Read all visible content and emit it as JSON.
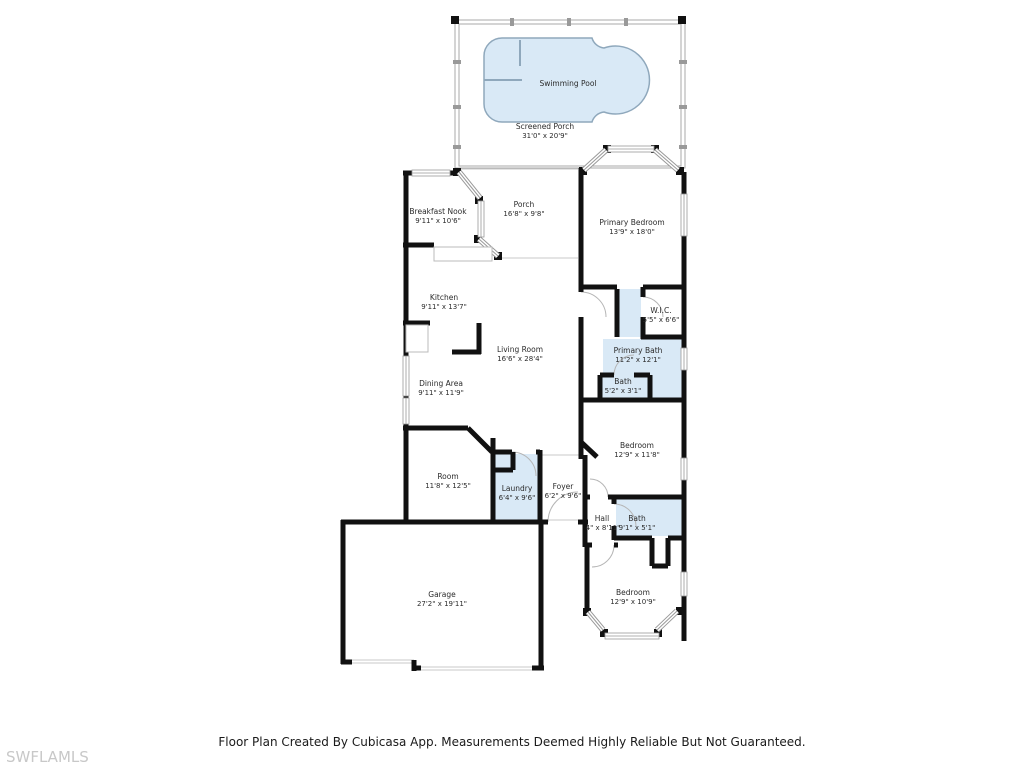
{
  "title": "Floor Plan",
  "footer": {
    "text": "Floor Plan Created By Cubicasa App. Measurements Deemed Highly Reliable But Not Guaranteed."
  },
  "watermark": {
    "text": "SWFLAMLS"
  },
  "colors": {
    "wall": "#111111",
    "water": "#d9e9f6",
    "pool_stroke": "#8fa8bc",
    "window": "#999999",
    "screen_wall": "#aaaaaa",
    "open_line": "#c9c9c9",
    "label": "#2b2b2b",
    "watermark": "#c8c8c8"
  },
  "rooms": [
    {
      "name": "Swimming Pool",
      "dims": ""
    },
    {
      "name": "Screened Porch",
      "dims": "31'0\" x 20'9\""
    },
    {
      "name": "Breakfast Nook",
      "dims": "9'11\" x 10'6\""
    },
    {
      "name": "Porch",
      "dims": "16'8\" x 9'8\""
    },
    {
      "name": "Primary Bedroom",
      "dims": "13'9\" x 18'0\""
    },
    {
      "name": "Kitchen",
      "dims": "9'11\" x 13'7\""
    },
    {
      "name": "W.I.C.",
      "dims": "5'5\" x 6'6\""
    },
    {
      "name": "Living Room",
      "dims": "16'6\" x 28'4\""
    },
    {
      "name": "Primary Bath",
      "dims": "11'2\" x 12'1\""
    },
    {
      "name": "Dining Area",
      "dims": "9'11\" x 11'9\""
    },
    {
      "name": "Bath",
      "dims": "5'2\" x 3'1\""
    },
    {
      "name": "Bedroom",
      "dims": "12'9\" x 11'8\""
    },
    {
      "name": "Room",
      "dims": "11'8\" x 12'5\""
    },
    {
      "name": "Laundry",
      "dims": "6'4\" x 9'6\""
    },
    {
      "name": "Foyer",
      "dims": "6'2\" x 9'6\""
    },
    {
      "name": "Hall",
      "dims": "4\" x 8'11\""
    },
    {
      "name": "Bath",
      "dims": "9'1\" x 5'1\""
    },
    {
      "name": "Garage",
      "dims": "27'2\" x 19'11\""
    },
    {
      "name": "Bedroom",
      "dims": "12'9\" x 10'9\""
    }
  ]
}
